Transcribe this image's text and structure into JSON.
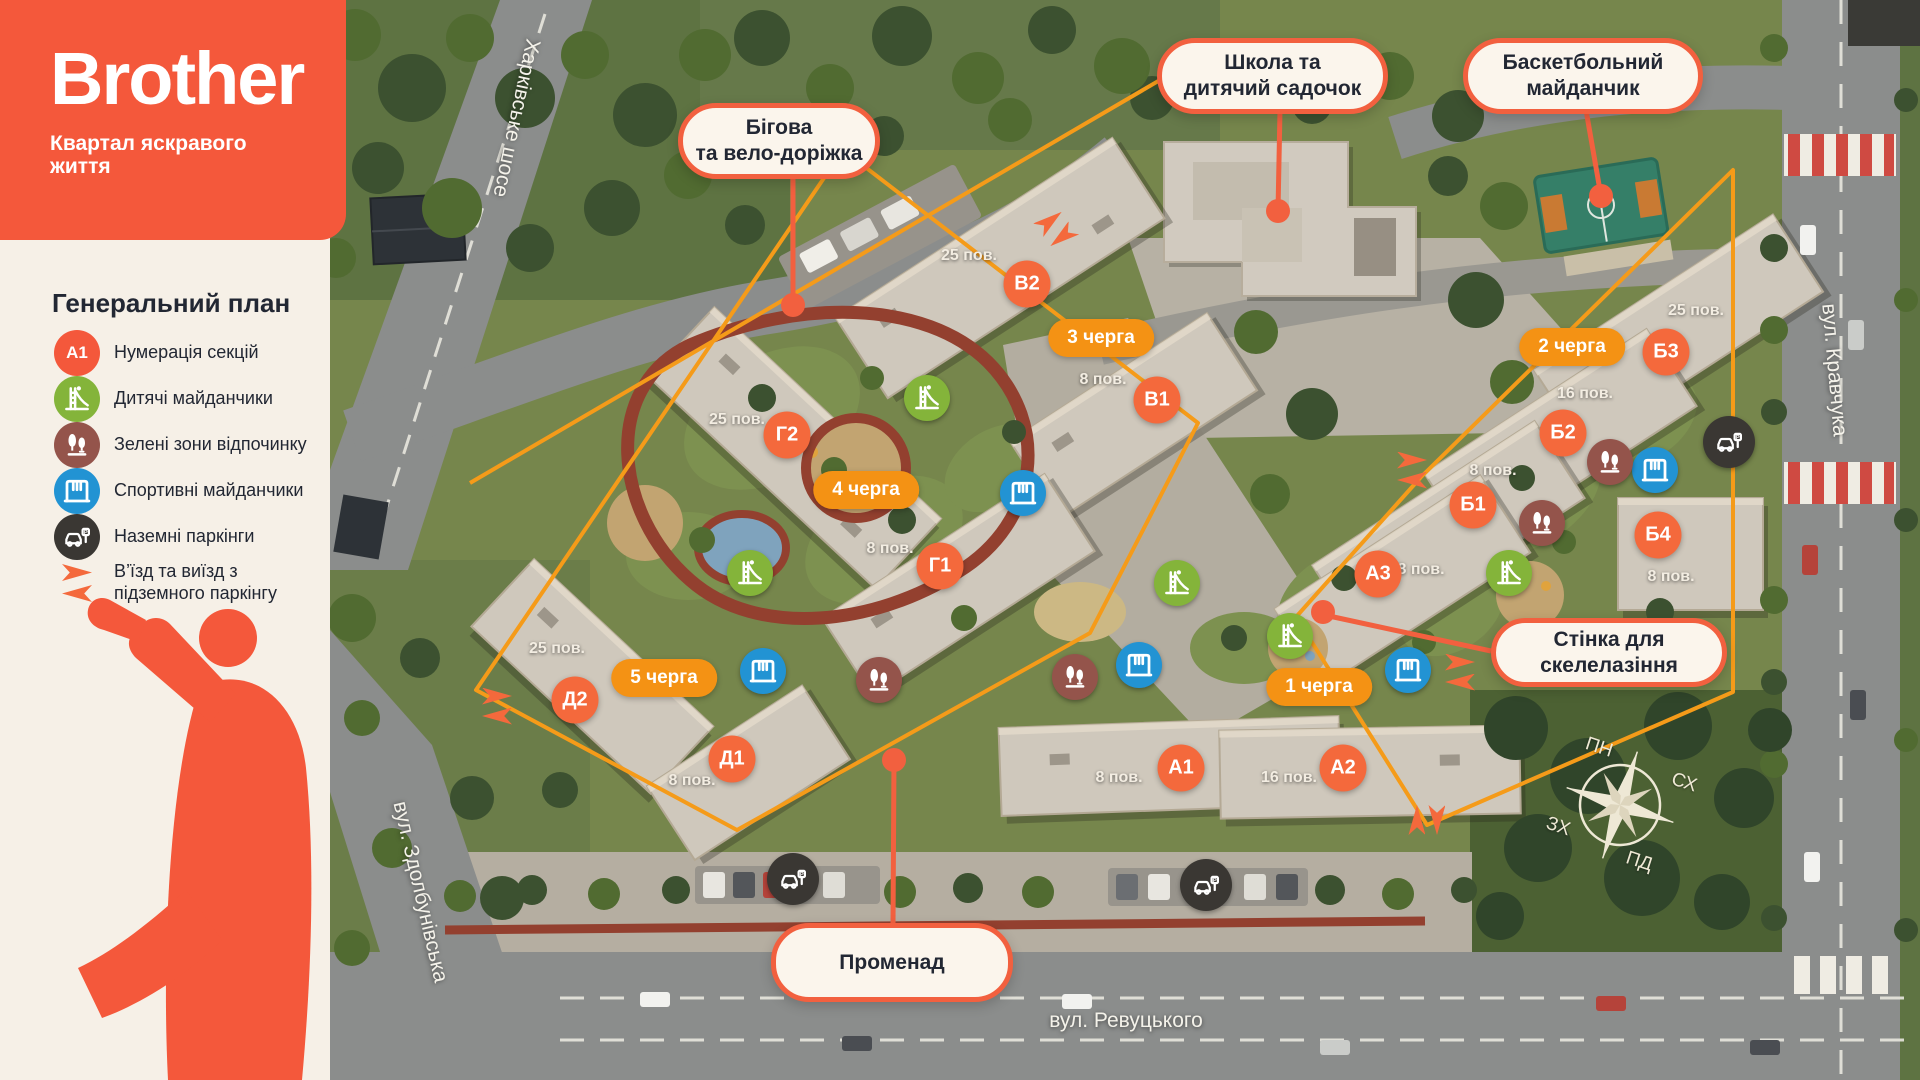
{
  "brand": {
    "logo": "Brother",
    "tagline": "Квартал яскравого\nжиття"
  },
  "legend": {
    "title": "Генеральний план",
    "items": [
      {
        "type": "section",
        "badge": "А1",
        "label": "Нумерація секцій"
      },
      {
        "type": "playground",
        "label": "Дитячі майданчики"
      },
      {
        "type": "greenzone",
        "label": "Зелені зони відпочинку"
      },
      {
        "type": "sports",
        "label": "Спортивні майданчики"
      },
      {
        "type": "parking",
        "label": "Наземні паркінги"
      },
      {
        "type": "arrows",
        "label": "В’їзд та виїзд з\nпідземного паркінгу"
      }
    ]
  },
  "colors": {
    "brand_orange": "#f4583b",
    "section_orange": "#f4693c",
    "phase_amber": "#f49214",
    "callout_border": "#f2603f",
    "playground_green": "#84b43a",
    "greenzone_maroon": "#94544b",
    "sports_blue": "#2293d3",
    "parking_dark": "#3a3733",
    "boundary_amber": "#f59b19"
  },
  "map": {
    "callouts": [
      {
        "id": "running-track",
        "text": "Бігова\nта вело-доріжка",
        "x": 678,
        "y": 103,
        "w": 202,
        "h": 76
      },
      {
        "id": "school",
        "text": "Школа та\nдитячий садочок",
        "x": 1157,
        "y": 38,
        "w": 231,
        "h": 76
      },
      {
        "id": "basketball",
        "text": "Баскетбольний\nмайданчик",
        "x": 1463,
        "y": 38,
        "w": 240,
        "h": 76
      },
      {
        "id": "climbing-wall",
        "text": "Стінка для\nскелелазіння",
        "x": 1491,
        "y": 618,
        "w": 236,
        "h": 69
      },
      {
        "id": "promenade",
        "text": "Променад",
        "x": 771,
        "y": 923,
        "w": 242,
        "h": 79
      }
    ],
    "sections": [
      {
        "label": "В2",
        "x": 1027,
        "y": 284
      },
      {
        "label": "В1",
        "x": 1157,
        "y": 400
      },
      {
        "label": "Г2",
        "x": 787,
        "y": 435
      },
      {
        "label": "Г1",
        "x": 940,
        "y": 566
      },
      {
        "label": "Д2",
        "x": 575,
        "y": 700
      },
      {
        "label": "Д1",
        "x": 732,
        "y": 759
      },
      {
        "label": "Б3",
        "x": 1666,
        "y": 352
      },
      {
        "label": "Б2",
        "x": 1563,
        "y": 433
      },
      {
        "label": "Б1",
        "x": 1473,
        "y": 505
      },
      {
        "label": "Б4",
        "x": 1658,
        "y": 535
      },
      {
        "label": "А3",
        "x": 1378,
        "y": 574
      },
      {
        "label": "А1",
        "x": 1181,
        "y": 768
      },
      {
        "label": "А2",
        "x": 1343,
        "y": 768
      }
    ],
    "phases": [
      {
        "label": "3 черга",
        "x": 1101,
        "y": 338
      },
      {
        "label": "4 черга",
        "x": 866,
        "y": 490
      },
      {
        "label": "5 черга",
        "x": 664,
        "y": 678
      },
      {
        "label": "2 черга",
        "x": 1572,
        "y": 347
      },
      {
        "label": "1 черга",
        "x": 1319,
        "y": 687
      }
    ],
    "floors": [
      {
        "label": "25 пов.",
        "x": 969,
        "y": 256
      },
      {
        "label": "8 пов.",
        "x": 1103,
        "y": 380
      },
      {
        "label": "25 пов.",
        "x": 737,
        "y": 420
      },
      {
        "label": "8 пов.",
        "x": 890,
        "y": 549
      },
      {
        "label": "25 пов.",
        "x": 557,
        "y": 649
      },
      {
        "label": "8 пов.",
        "x": 692,
        "y": 781
      },
      {
        "label": "25 пов.",
        "x": 1696,
        "y": 311
      },
      {
        "label": "16 пов.",
        "x": 1585,
        "y": 394
      },
      {
        "label": "8 пов.",
        "x": 1493,
        "y": 471
      },
      {
        "label": "8 пов.",
        "x": 1671,
        "y": 577
      },
      {
        "label": "8 пов.",
        "x": 1421,
        "y": 570
      },
      {
        "label": "8 пов.",
        "x": 1119,
        "y": 778
      },
      {
        "label": "16 пов.",
        "x": 1289,
        "y": 778
      }
    ],
    "streets": [
      {
        "label": "Харківське шосе",
        "x": 516,
        "y": 118,
        "rot": 102
      },
      {
        "label": "вул. Кравчука",
        "x": 1834,
        "y": 370,
        "rot": 85
      },
      {
        "label": "вул. Здолбунівська",
        "x": 420,
        "y": 892,
        "rot": 77
      },
      {
        "label": "вул. Ревуцького",
        "x": 1126,
        "y": 1021,
        "rot": 0
      }
    ],
    "compass": {
      "labels": [
        {
          "t": "ПН",
          "x": 1599,
          "y": 748,
          "rot": 18
        },
        {
          "t": "СХ",
          "x": 1684,
          "y": 783,
          "rot": 18
        },
        {
          "t": "ЗХ",
          "x": 1558,
          "y": 827,
          "rot": 18
        },
        {
          "t": "ПД",
          "x": 1639,
          "y": 862,
          "rot": 18
        }
      ]
    },
    "markers": [
      {
        "type": "playground",
        "x": 927,
        "y": 398
      },
      {
        "type": "playground",
        "x": 750,
        "y": 573
      },
      {
        "type": "playground",
        "x": 1177,
        "y": 583
      },
      {
        "type": "playground",
        "x": 1290,
        "y": 636
      },
      {
        "type": "playground",
        "x": 1509,
        "y": 573
      },
      {
        "type": "sports",
        "x": 1023,
        "y": 493
      },
      {
        "type": "sports",
        "x": 763,
        "y": 671
      },
      {
        "type": "sports",
        "x": 1139,
        "y": 665
      },
      {
        "type": "sports",
        "x": 1408,
        "y": 670
      },
      {
        "type": "sports",
        "x": 1655,
        "y": 470
      },
      {
        "type": "greenzone",
        "x": 879,
        "y": 680
      },
      {
        "type": "greenzone",
        "x": 1075,
        "y": 677
      },
      {
        "type": "greenzone",
        "x": 1610,
        "y": 462
      },
      {
        "type": "greenzone",
        "x": 1542,
        "y": 523
      },
      {
        "type": "parking",
        "x": 1729,
        "y": 442
      },
      {
        "type": "parking",
        "x": 793,
        "y": 879
      },
      {
        "type": "parking",
        "x": 1206,
        "y": 885
      },
      {
        "type": "arrows",
        "x": 1056,
        "y": 229,
        "rot": -38
      },
      {
        "type": "arrows",
        "x": 497,
        "y": 706,
        "rot": 0
      },
      {
        "type": "arrows",
        "x": 1412,
        "y": 470,
        "rot": 0
      },
      {
        "type": "arrows",
        "x": 1460,
        "y": 672,
        "rot": 0
      },
      {
        "type": "arrows",
        "x": 1427,
        "y": 820,
        "rot": 90
      }
    ]
  }
}
